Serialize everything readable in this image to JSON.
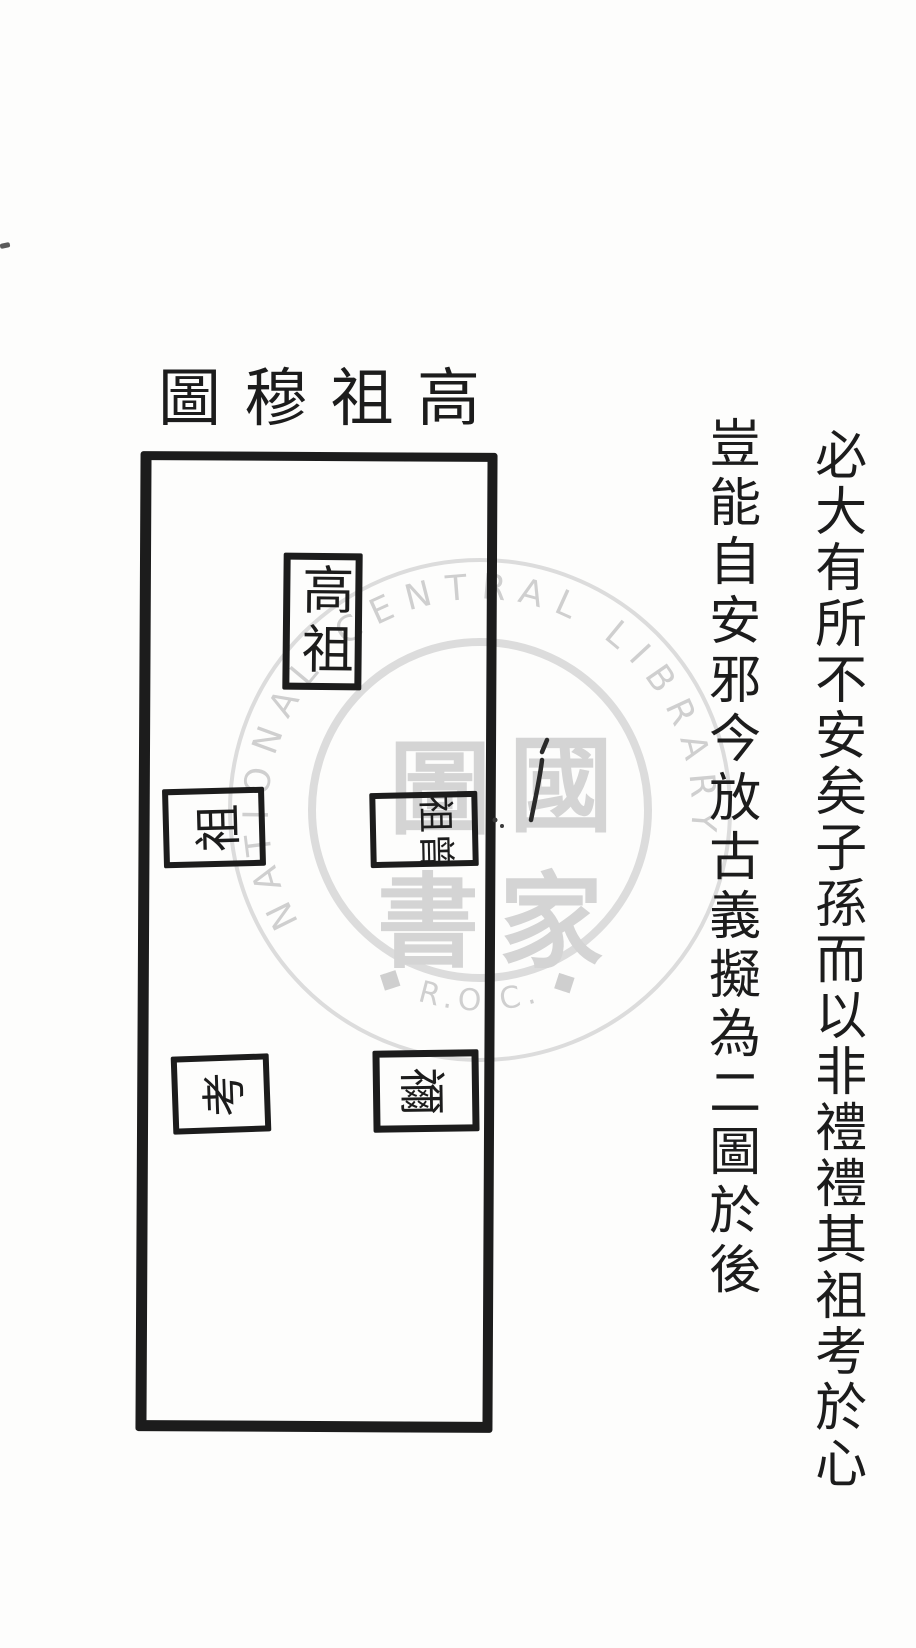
{
  "page": {
    "background": "#fdfdfc",
    "ink_color": "#1c1c1c",
    "watermark_color": "#d4d4d4"
  },
  "title": {
    "text": "高祖穆圖",
    "display_chars": [
      "圖",
      "穆",
      "祖",
      "高"
    ]
  },
  "diagram": {
    "boxes": [
      {
        "name": "gaozu",
        "label": "高祖",
        "orientation": "upright"
      },
      {
        "name": "zu",
        "label": "祖",
        "orientation": "rotated-ccw"
      },
      {
        "name": "zengzu",
        "label": "曾祖",
        "orientation": "rotated-cw"
      },
      {
        "name": "kao",
        "label": "考",
        "orientation": "rotated-ccw"
      },
      {
        "name": "ni",
        "label": "禰",
        "orientation": "rotated-cw"
      }
    ]
  },
  "commentary": {
    "columns": [
      {
        "text": "必大有所不安矣子孫而以非禮禮其祖考於心"
      },
      {
        "text": "豈能自安邪今放古義擬為二圖於後"
      }
    ]
  },
  "watermark": {
    "arc_text": "NATIONAL CENTRAL LIBRARY",
    "bottom_text": "R.O.C.",
    "bottom_display": "◆ R.O.C. ◆",
    "emblem_chars": [
      "圖",
      "國",
      "書",
      "家"
    ]
  }
}
